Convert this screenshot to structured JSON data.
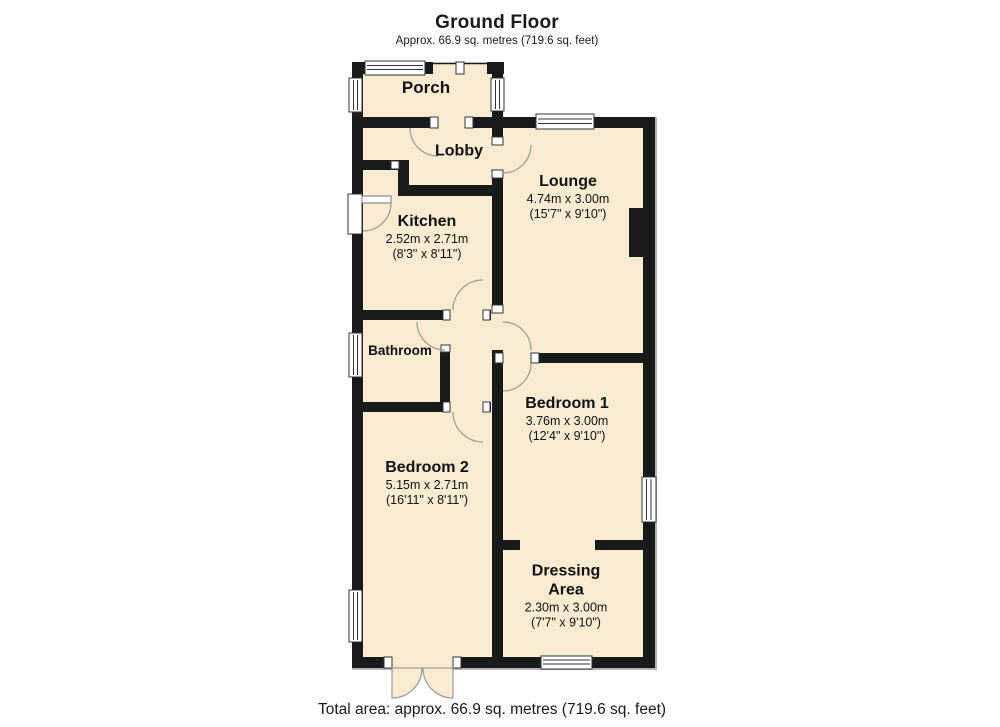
{
  "header": {
    "title": "Ground Floor",
    "subtitle": "Approx. 66.9 sq. metres (719.6 sq. feet)"
  },
  "footer": {
    "total_area": "Total area: approx. 66.9 sq. metres (719.6 sq. feet)"
  },
  "colors": {
    "room_fill": "#faecd2",
    "wall": "#1a1a1a",
    "door_arc": "#9a9a93",
    "window_frame": "#333333"
  },
  "rooms": {
    "porch": {
      "name": "Porch"
    },
    "lobby": {
      "name": "Lobby"
    },
    "kitchen": {
      "name": "Kitchen",
      "dim_m": "2.52m x 2.71m",
      "dim_ft": "(8'3\" x 8'11\")"
    },
    "lounge": {
      "name": "Lounge",
      "dim_m": "4.74m x 3.00m",
      "dim_ft": "(15'7\" x 9'10\")"
    },
    "bathroom": {
      "name": "Bathroom"
    },
    "bedroom1": {
      "name": "Bedroom 1",
      "dim_m": "3.76m x 3.00m",
      "dim_ft": "(12'4\" x 9'10\")"
    },
    "bedroom2": {
      "name": "Bedroom 2",
      "dim_m": "5.15m x 2.71m",
      "dim_ft": "(16'11\" x 8'11\")"
    },
    "dressing": {
      "name": "Dressing Area",
      "dim_m": "2.30m x 3.00m",
      "dim_ft": "(7'7\" x 9'10\")"
    }
  }
}
